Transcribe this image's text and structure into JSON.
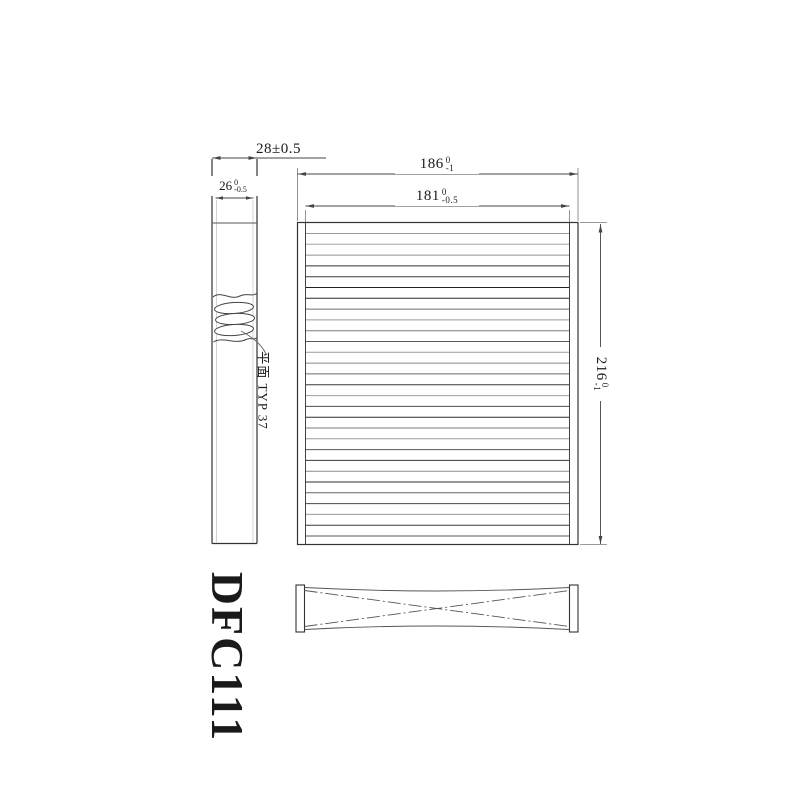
{
  "drawing": {
    "part_number": "DFC111",
    "note": "平面 TYP 37",
    "side_view": {
      "dim_outer_depth": {
        "value": "28±0.5"
      },
      "dim_inner_depth": {
        "value": "26",
        "tol_top": "0",
        "tol_bottom": "-0.5"
      }
    },
    "front_view": {
      "dim_outer_width": {
        "value": "186",
        "tol_top": "0",
        "tol_bottom": "-1"
      },
      "dim_inner_width": {
        "value": "181",
        "tol_top": "0",
        "tol_bottom": "-0.5"
      },
      "dim_height": {
        "value": "216",
        "tol_top": "0",
        "tol_bottom": "-1"
      },
      "pleat_lines_visible": 29
    },
    "colors": {
      "outline": "#333333",
      "dimension": "#444444",
      "extension": "#777777",
      "background": "#ffffff"
    }
  }
}
